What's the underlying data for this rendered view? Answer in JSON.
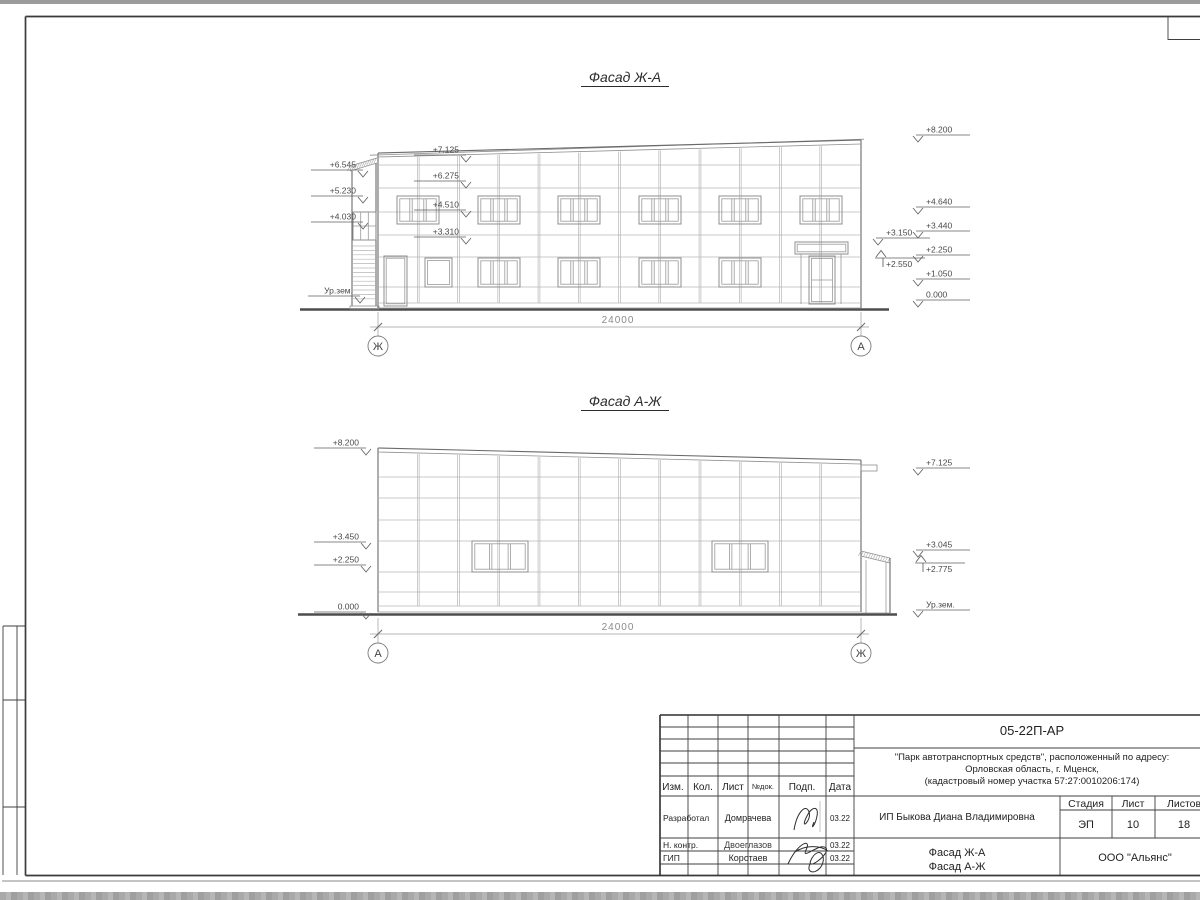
{
  "facades": {
    "top": {
      "title": "Фасад Ж-А",
      "dimension": "24000",
      "axis_left": "Ж",
      "axis_right": "А",
      "marks_left": [
        {
          "label": "+7.125",
          "x": 466,
          "y": 155
        },
        {
          "label": "+6.545",
          "x": 363,
          "y": 170
        },
        {
          "label": "+6.275",
          "x": 466,
          "y": 181
        },
        {
          "label": "+5.230",
          "x": 363,
          "y": 196
        },
        {
          "label": "+4.510",
          "x": 466,
          "y": 210
        },
        {
          "label": "+4.030",
          "x": 363,
          "y": 222
        },
        {
          "label": "+3.310",
          "x": 466,
          "y": 237
        },
        {
          "label": "Ур.зем.",
          "x": 360,
          "y": 296
        }
      ],
      "marks_right": [
        {
          "label": "+8.200",
          "x": 918,
          "y": 135
        },
        {
          "label": "+4.640",
          "x": 918,
          "y": 207
        },
        {
          "label": "+3.440",
          "x": 918,
          "y": 231
        },
        {
          "label": "+2.250",
          "x": 918,
          "y": 255
        },
        {
          "label": "+1.050",
          "x": 918,
          "y": 279
        },
        {
          "label": "0.000",
          "x": 918,
          "y": 300
        },
        {
          "label": "+3.150",
          "x": 878,
          "y": 238
        },
        {
          "label": "+2.550",
          "x": 877,
          "y": 258,
          "dir": "up-left"
        }
      ]
    },
    "bottom": {
      "title": "Фасад А-Ж",
      "dimension": "24000",
      "axis_left": "А",
      "axis_right": "Ж",
      "marks_left": [
        {
          "label": "+8.200",
          "x": 366,
          "y": 448
        },
        {
          "label": "+3.450",
          "x": 366,
          "y": 542
        },
        {
          "label": "+2.250",
          "x": 366,
          "y": 565
        },
        {
          "label": "0.000",
          "x": 366,
          "y": 612
        }
      ],
      "marks_right": [
        {
          "label": "+7.125",
          "x": 918,
          "y": 468
        },
        {
          "label": "+3.045",
          "x": 918,
          "y": 550
        },
        {
          "label": "+2.775",
          "x": 917,
          "y": 563,
          "dir": "up-left"
        },
        {
          "label": "Ур.зем.",
          "x": 918,
          "y": 610
        }
      ]
    }
  },
  "title_block": {
    "code": "05-22П-АР",
    "description_lines": [
      "\"Парк автотранспортных средств\",  расположенный по адресу:",
      "Орловская область, г. Мценск,",
      "(кадастровый номер участка 57:27:0010206:174)"
    ],
    "client": "ИП Быкова Диана Владимировна",
    "sheet_title_line1": "Фасад Ж-А",
    "sheet_title_line2": "Фасад А-Ж",
    "organization": "ООО \"Альянс\"",
    "columns": {
      "izm": "Изм.",
      "kol": "Кол.",
      "list": "Лист",
      "ndok": "№док.",
      "podp": "Подп.",
      "data": "Дата"
    },
    "stage_header": {
      "stage": "Стадия",
      "sheet": "Лист",
      "sheets": "Листов"
    },
    "stage_values": {
      "stage": "ЭП",
      "sheet": "10",
      "sheets": "18"
    },
    "roles": [
      {
        "role": "Разработал",
        "name": "Домрачева",
        "date": "03.22"
      },
      {
        "role": "Н. контр.",
        "name": "Двоеглазов",
        "date": "03.22"
      },
      {
        "role": "ГИП",
        "name": "Коротаев",
        "date": "03.22"
      }
    ]
  }
}
